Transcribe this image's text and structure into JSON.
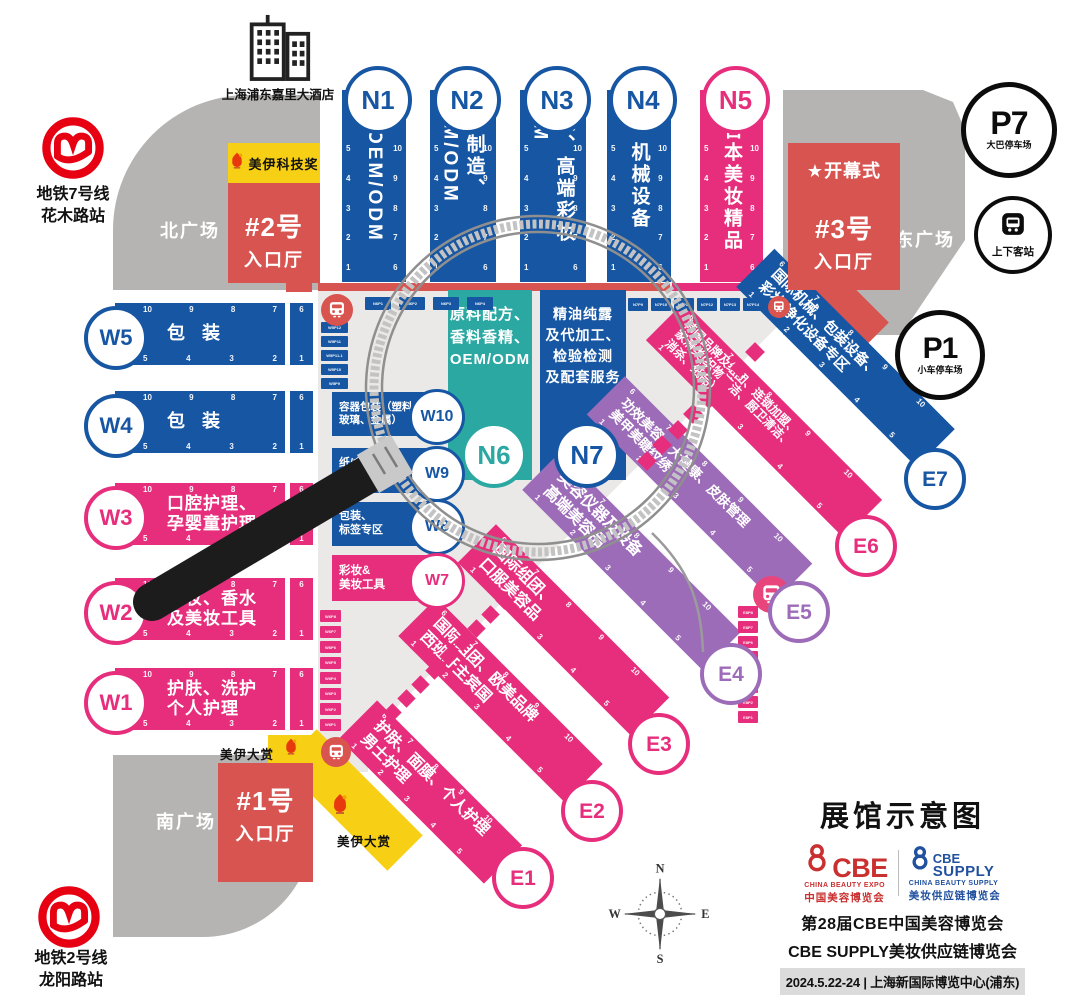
{
  "colors": {
    "blue": "#1656a3",
    "teal": "#2ba8a2",
    "pink": "#e72e7c",
    "purple": "#9d6cb8",
    "red": "#d85450",
    "yellow": "#f7cf15",
    "road_gray": "#b5b4b2",
    "panel_gray": "#eae9e7",
    "metro_red": "#e60012",
    "cbe_red": "#c9302f",
    "cbe_blue": "#20509e",
    "black": "#0c0c0c"
  },
  "icons": {
    "metro": "metro-logo",
    "hotel": "hotel-icon",
    "bus": "bus-icon",
    "star": "★",
    "compass": "compass-rose",
    "magnifier": "magnifier-graphic",
    "meiyi": "meiyi-award-logo"
  },
  "landmarks": {
    "hotel": "上海浦东嘉里大酒店"
  },
  "stations": {
    "metro7": {
      "line1": "地铁7号线",
      "line2": "花木路站"
    },
    "metro2": {
      "line1": "地铁2号线",
      "line2": "龙阳路站"
    }
  },
  "plazas": {
    "north": "北广场",
    "east": "东广场",
    "south": "南广场"
  },
  "entrances": {
    "e2": {
      "name": "#2号",
      "hall": "入口厅",
      "award": "美伊科技奖"
    },
    "e3": {
      "name": "#3号",
      "hall": "入口厅",
      "star": "★",
      "ceremony": "开幕式"
    },
    "e1": {
      "name": "#1号",
      "hall": "入口厅"
    }
  },
  "award_grand": "美伊大赏",
  "parking": {
    "p7": {
      "code": "P7",
      "label": "大巴停车场"
    },
    "p1": {
      "code": "P1",
      "label": "小车停车场"
    },
    "stop": {
      "label": "上下客站"
    }
  },
  "n_halls": [
    {
      "id": "N1",
      "label": "OEM/ODM",
      "pink": false
    },
    {
      "id": "N2",
      "label": "日本制造、OEM/ODM",
      "pink": false
    },
    {
      "id": "N3",
      "label": "包装、高端彩妆OEM",
      "pink": false
    },
    {
      "id": "N4",
      "label": "机械设备",
      "pink": false
    },
    {
      "id": "N5",
      "label": "日本美妆精品",
      "pink": true
    }
  ],
  "n_center": [
    {
      "id": "N6",
      "lines": [
        "原料配方、",
        "香料香精、",
        "OEM/ODM"
      ]
    },
    {
      "id": "N7",
      "lines": [
        "精油纯露",
        "及代加工、",
        "检验检测",
        "及配套服务"
      ]
    }
  ],
  "w_rows": [
    {
      "id": "W5",
      "lines": [
        "包 装"
      ],
      "pink": false
    },
    {
      "id": "W4",
      "lines": [
        "包 装"
      ],
      "pink": false
    },
    {
      "id": "W3",
      "lines": [
        "口腔护理、",
        "孕婴童护理"
      ],
      "pink": true
    },
    {
      "id": "W2",
      "lines": [
        "彩妆、香水",
        "及美妆工具"
      ],
      "pink": true
    },
    {
      "id": "W1",
      "lines": [
        "护肤、洗护",
        "个人护理"
      ],
      "pink": true
    }
  ],
  "w_mid": [
    {
      "id": "W10",
      "lines": [
        "容器包装（塑料、",
        "玻璃、金属）"
      ],
      "pink": false
    },
    {
      "id": "W9",
      "lines": [
        "纸/盒",
        "/("
      ],
      "pink": false
    },
    {
      "id": "W8",
      "lines": [
        "包装、",
        "标签专区"
      ],
      "pink": false
    },
    {
      "id": "W7",
      "lines": [
        "彩妆&",
        "美妆工具"
      ],
      "pink": true
    }
  ],
  "e_bands": [
    {
      "id": "E1",
      "lines": [
        "护肤、面膜、个人护理",
        "男士护理"
      ],
      "color": "pink"
    },
    {
      "id": "E2",
      "lines": [
        "国际组团、欧美品牌",
        "西班牙主宾国"
      ],
      "color": "pink"
    },
    {
      "id": "E3",
      "lines": [
        "国际组团、",
        "口服美容品"
      ],
      "color": "pink"
    },
    {
      "id": "E4",
      "lines": [
        "美容仪器及设备",
        "高端美容品"
      ],
      "color": "purple"
    },
    {
      "id": "E5",
      "lines": [
        "功效美容、大健康、皮肤管理",
        "美甲美睫纹绣"
      ],
      "color": "purple"
    },
    {
      "id": "E6",
      "lines": [
        "韩国品牌及组团、连锁加盟、",
        "家清类(织物清洁、厨卫清洁、",
        "消杀、纸品）"
      ],
      "color": "pink"
    },
    {
      "id": "E7",
      "lines": [
        "国际机械、包装设备、",
        "彩妆/净化设备专区"
      ],
      "color": "blue"
    }
  ],
  "numbers": {
    "col_left": [
      "5",
      "4",
      "3",
      "2",
      "1"
    ],
    "col_right": [
      "10",
      "9",
      "8",
      "7",
      "6"
    ],
    "row_top": [
      "10",
      "9",
      "8",
      "7"
    ],
    "row_bottom": [
      "5",
      "4",
      "3",
      "2"
    ],
    "cap_top": "6",
    "cap_bottom": "1",
    "band_top": [
      "6",
      "7",
      "8",
      "9",
      "10"
    ],
    "band_bottom": [
      "1",
      "2",
      "3",
      "4",
      "5"
    ]
  },
  "tags": {
    "top_row_a": [
      "N6P1",
      "N6P2",
      "N6P3",
      "N6P4"
    ],
    "top_row_b": [
      "N7P9",
      "N7P10",
      "N7P11",
      "N7P12",
      "N7P13",
      "N7P14"
    ],
    "left_stack": [
      "W5P12",
      "W5P11",
      "W5P11-1",
      "W5P10",
      "W5P9"
    ],
    "pink_stack_left": [
      "W6P8",
      "W6P7",
      "W6P6",
      "W6P5",
      "W6P4",
      "W6P3",
      "W6P2",
      "W6P1"
    ],
    "pink_stack_right": [
      "E8P8",
      "E8P7",
      "E8P6",
      "E8P5",
      "E8P4",
      "E8P3",
      "E8P2",
      "E8P1"
    ]
  },
  "legend": {
    "title": "展馆示意图",
    "cbe": {
      "name": "CBE",
      "sub1": "CHINA BEAUTY EXPO",
      "sub2": "中国美容博览会"
    },
    "supply": {
      "name": "CBE",
      "name2": "SUPPLY",
      "sub1": "CHINA BEAUTY SUPPLY",
      "sub2": "美妆供应链博览会"
    },
    "line1": "第28届CBE中国美容博览会",
    "line2": "CBE SUPPLY美妆供应链博览会",
    "line3": "2024.5.22-24 | 上海新国际博览中心(浦东)"
  },
  "compass": {
    "n": "N",
    "e": "E",
    "s": "S",
    "w": "W"
  }
}
